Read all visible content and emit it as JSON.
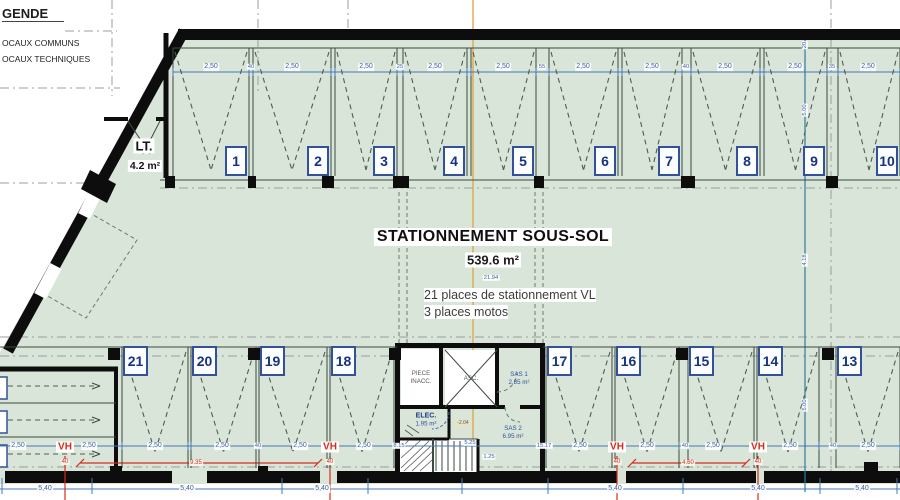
{
  "colors": {
    "floor": "#d8e5d8",
    "wall": "#0d0d0d",
    "dim_blue": "#3b5fa6",
    "line_blue": "#4679b8",
    "teal": "#2e7d9e",
    "centerline_orange": "#e0a23c",
    "red": "#d62c1e",
    "number_navy": "#17337f"
  },
  "legend": {
    "title": "GENDE",
    "items": [
      "OCAUX COMMUNS",
      "OCAUX TECHNIQUES"
    ]
  },
  "lt_room": {
    "name": "LT.",
    "area": "4.2 m²"
  },
  "title_block": {
    "title": "STATIONNEMENT SOUS-SOL",
    "area": "539.6 m²",
    "dim": "21.94",
    "line1": "21 places de stationnement VL",
    "line2": "3 places motos"
  },
  "rooms": {
    "piece": {
      "line1": "PIECE",
      "line2": "INACC."
    },
    "asc": {
      "name": "ASC."
    },
    "sas1": {
      "name": "SAS 1",
      "area": "2.85 m²"
    },
    "elec": {
      "name": "ELEC.",
      "area": "1.95 m²"
    },
    "sas2": {
      "name": "SAS 2",
      "area": "6.95 m²"
    },
    "level": "-2.04"
  },
  "stalls": {
    "top": [
      "1",
      "2",
      "3",
      "4",
      "5",
      "6",
      "7",
      "8",
      "9",
      "10"
    ],
    "bottom": [
      "21",
      "20",
      "19",
      "18",
      "17",
      "16",
      "15",
      "14",
      "13"
    ]
  },
  "dims": {
    "top": [
      {
        "x": 211,
        "t": "2,50"
      },
      {
        "x": 292,
        "t": "2,50"
      },
      {
        "x": 366,
        "t": "2,50"
      },
      {
        "x": 435,
        "t": "2,50"
      },
      {
        "x": 503,
        "t": "2,50"
      },
      {
        "x": 583,
        "t": "2,50"
      },
      {
        "x": 652,
        "t": "2,50"
      },
      {
        "x": 725,
        "t": "2,50"
      },
      {
        "x": 795,
        "t": "2,50"
      },
      {
        "x": 868,
        "t": "2,50"
      },
      {
        "x": 251,
        "t": "40",
        "s": 1
      },
      {
        "x": 400,
        "t": "25",
        "s": 1
      },
      {
        "x": 542,
        "t": "55",
        "s": 1
      },
      {
        "x": 686,
        "t": "40",
        "s": 1
      },
      {
        "x": 832,
        "t": "35",
        "s": 1
      }
    ],
    "bottom": [
      {
        "x": 18,
        "t": "2,50"
      },
      {
        "x": 89,
        "t": "2,50"
      },
      {
        "x": 155,
        "t": "2,50"
      },
      {
        "x": 222,
        "t": "2,50"
      },
      {
        "x": 300,
        "t": "2,50"
      },
      {
        "x": 364,
        "t": "2,50"
      },
      {
        "x": 580,
        "t": "2,50"
      },
      {
        "x": 647,
        "t": "2,50"
      },
      {
        "x": 713,
        "t": "2,50"
      },
      {
        "x": 790,
        "t": "2,50"
      },
      {
        "x": 868,
        "t": "2,50"
      },
      {
        "x": 258,
        "t": "40",
        "s": 1
      },
      {
        "x": 685,
        "t": "40",
        "s": 1
      },
      {
        "x": 833,
        "t": "40",
        "s": 1
      },
      {
        "x": 399,
        "t": "8.15",
        "s": 1
      },
      {
        "x": 544,
        "t": "15.17",
        "s": 1
      }
    ],
    "outer": [
      {
        "x": 45,
        "t": "5,40"
      },
      {
        "x": 187,
        "t": "5,40"
      },
      {
        "x": 322,
        "t": "5,40"
      },
      {
        "x": 615,
        "t": "5,40"
      },
      {
        "x": 758,
        "t": "5,40"
      },
      {
        "x": 862,
        "t": "5,40"
      }
    ],
    "right": [
      {
        "y": 45,
        "t": "20"
      },
      {
        "y": 110,
        "t": "5.00"
      },
      {
        "y": 260,
        "t": "4.18"
      },
      {
        "y": 405,
        "t": "5.00"
      }
    ],
    "stairs": [
      {
        "x": 470,
        "y": 443,
        "t": "5.25"
      },
      {
        "x": 489,
        "y": 457,
        "t": "1.25"
      }
    ]
  },
  "vents": {
    "label": "VH",
    "tick": "40",
    "positions": [
      65,
      330,
      617,
      758
    ],
    "spans": [
      {
        "lx": 196,
        "t": "9.35"
      },
      {
        "lx": 688,
        "t": "4.60"
      }
    ]
  }
}
